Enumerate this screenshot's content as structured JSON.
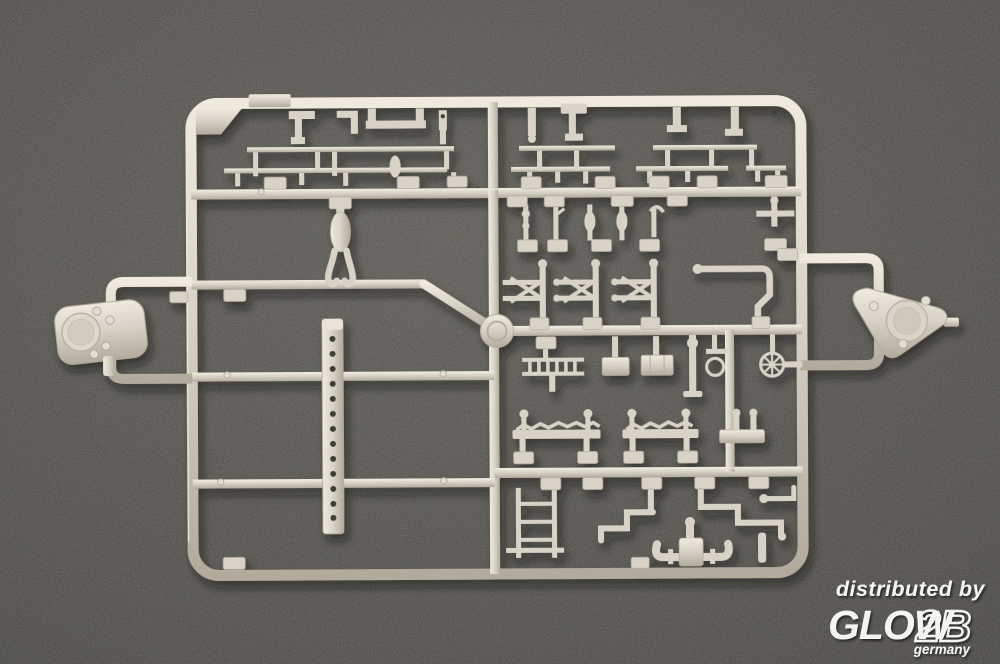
{
  "scene": {
    "type": "product photograph",
    "subject": "light grey injection-molded model kit sprue (parts runner) lying on a dark grey flocked surface",
    "surface": "dark grey speckled background"
  },
  "colors": {
    "background": "#56544e",
    "background-mid": "#474540",
    "background-edge": "#343330",
    "plastic": "#d8d3c6",
    "plastic-highlight": "#efeadd",
    "plastic-shadow": "#b2ab9c",
    "plastic-deep": "#9a9384",
    "hole": "#3e3c37",
    "watermark": "#f4f4f1",
    "cast-shadow": "#16140f"
  },
  "watermark": {
    "line1": "distributed by",
    "brand_solid": "GLOW",
    "brand_outline": "2B",
    "country": "germany"
  },
  "sprue": {
    "plastic_color_name": "light grey",
    "parts": [
      "rounded gun-mount base",
      "triangular mount base with round hatch",
      "perforated crane boom",
      "handrail sections",
      "deck brackets",
      "stanchions",
      "valve stems",
      "davit clusters",
      "bent piping",
      "horizontal ladder",
      "vertical ladder",
      "equipment blocks",
      "ship's helm wheel",
      "anchor-chain strips",
      "flanged pipe assembly",
      "part-number tabs",
      "sprue hub disc"
    ]
  }
}
